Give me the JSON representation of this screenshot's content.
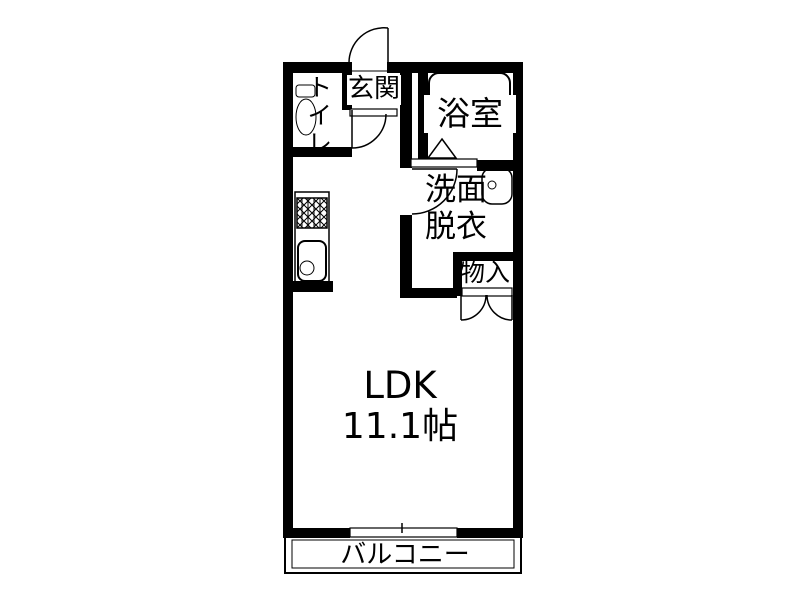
{
  "colors": {
    "wall": "#000000",
    "ink": "#000000",
    "bg": "#ffffff"
  },
  "floorplan": {
    "rooms": {
      "entrance": {
        "label": "玄関"
      },
      "toilet": {
        "label": "トイレ"
      },
      "bathroom": {
        "label": "浴室"
      },
      "washroom": {
        "line1": "洗面",
        "line2": "脱衣"
      },
      "storage": {
        "label": "物入"
      },
      "ldk": {
        "label": "LDK",
        "area": "11.1帖"
      },
      "balcony": {
        "label": "バルコニー"
      }
    },
    "icons": {
      "toilet": "toilet-icon",
      "bathtub": "bathtub-icon",
      "bathroom_door": "folding-door-triangle-icon",
      "washbasin": "washbasin-icon",
      "stove": "stove-burner-icon",
      "sink": "kitchen-sink-icon",
      "entrance_door": "swing-door-arc-icon",
      "hall_door": "swing-door-arc-icon",
      "washroom_door": "swing-door-arc-icon",
      "storage_door": "double-swing-door-icon",
      "balcony_window": "sliding-window-icon"
    }
  }
}
